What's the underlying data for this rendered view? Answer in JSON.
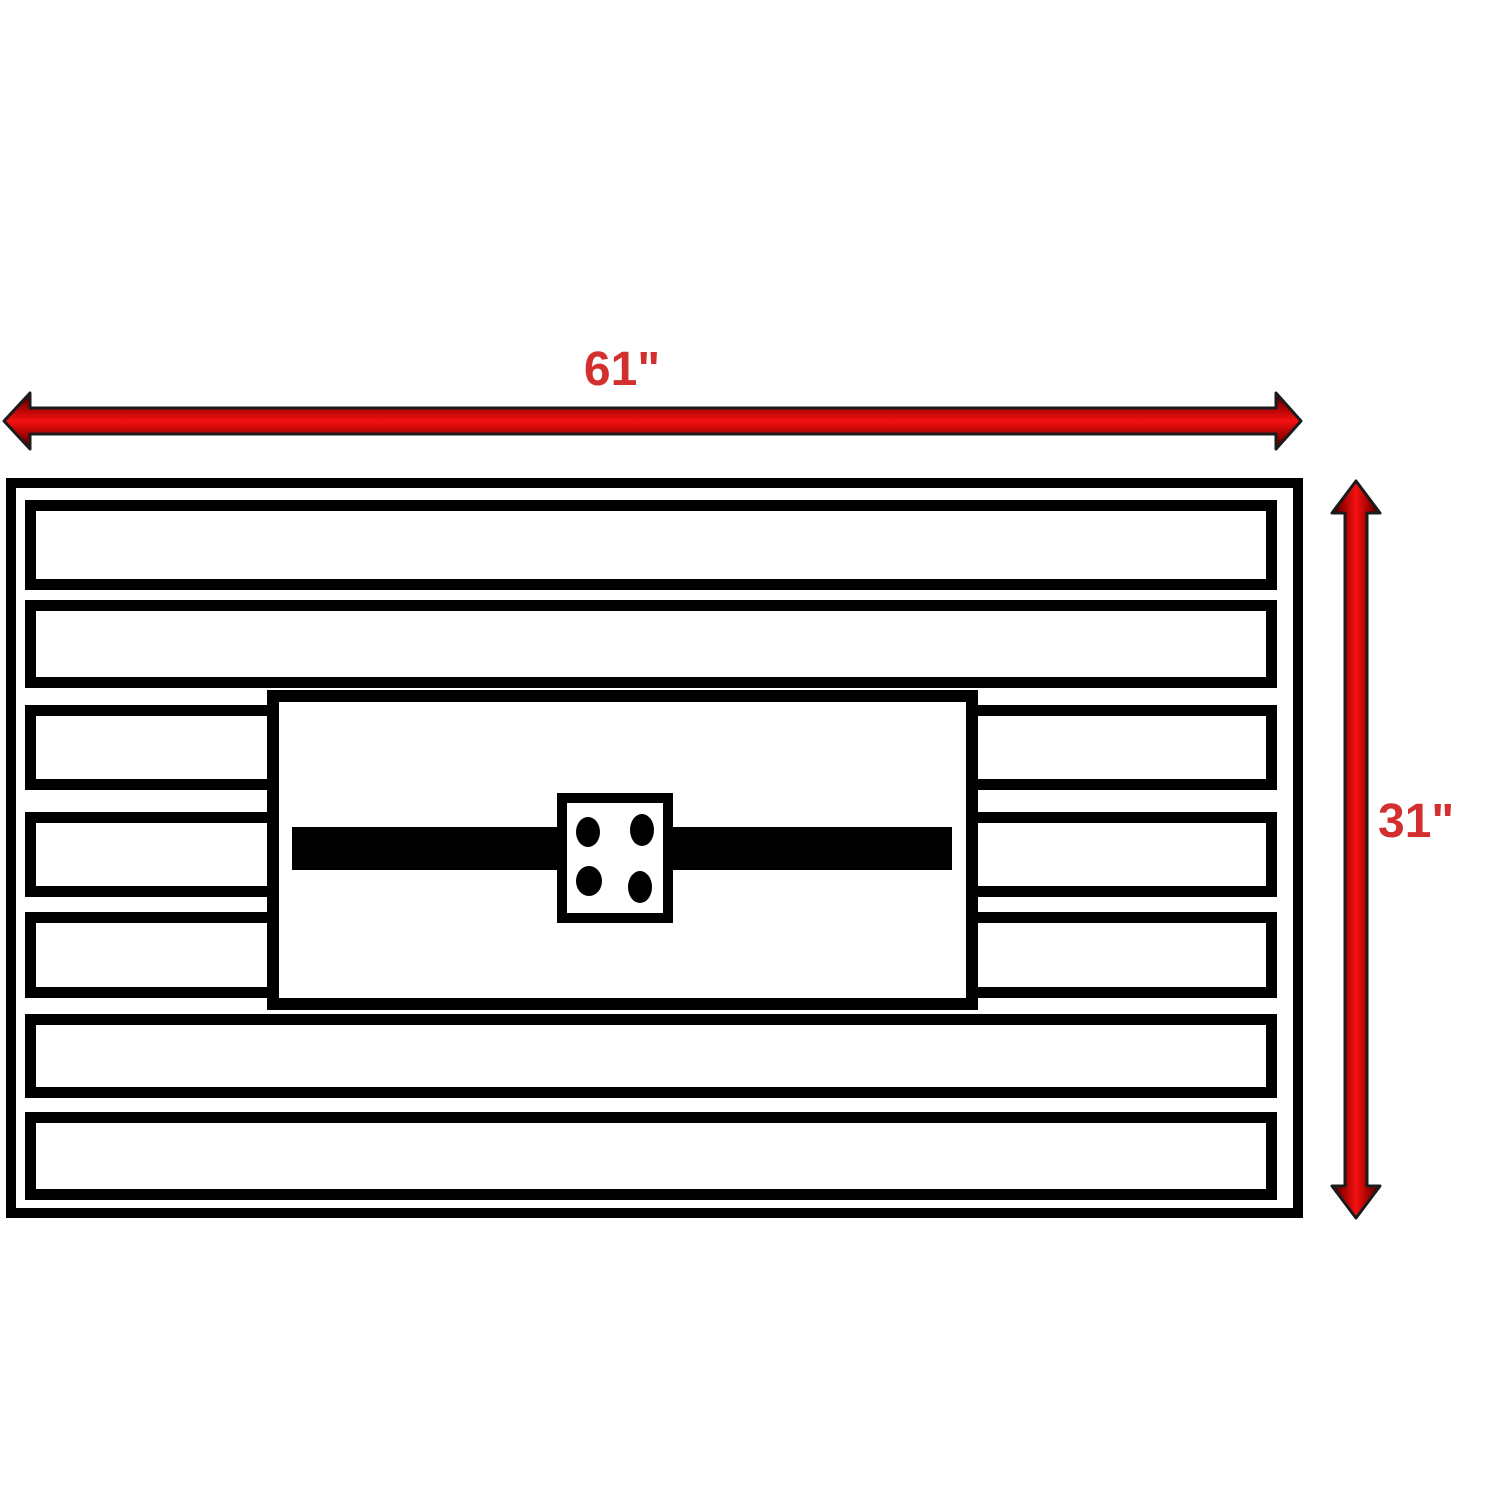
{
  "dimensions": {
    "width_label": "61\"",
    "height_label": "31\""
  },
  "figure": {
    "type": "dimension-diagram",
    "subject": "slatted rectangular table top with center panel, burner channel bar and 4-hole burner plate",
    "slat_count": 7,
    "split_slat_count": 3,
    "burner_hole_count": 4
  },
  "icons": {
    "width_arrow": "double-headed-arrow-horizontal",
    "height_arrow": "double-headed-arrow-vertical"
  },
  "colors": {
    "background": "#ffffff",
    "line_black": "#000000",
    "arrow_edge": "#2a0000",
    "arrow_mid": "#9b0000",
    "arrow_bright": "#f51111",
    "arrow_outline": "#1b1b1b",
    "label_red": "#d32f2f"
  }
}
